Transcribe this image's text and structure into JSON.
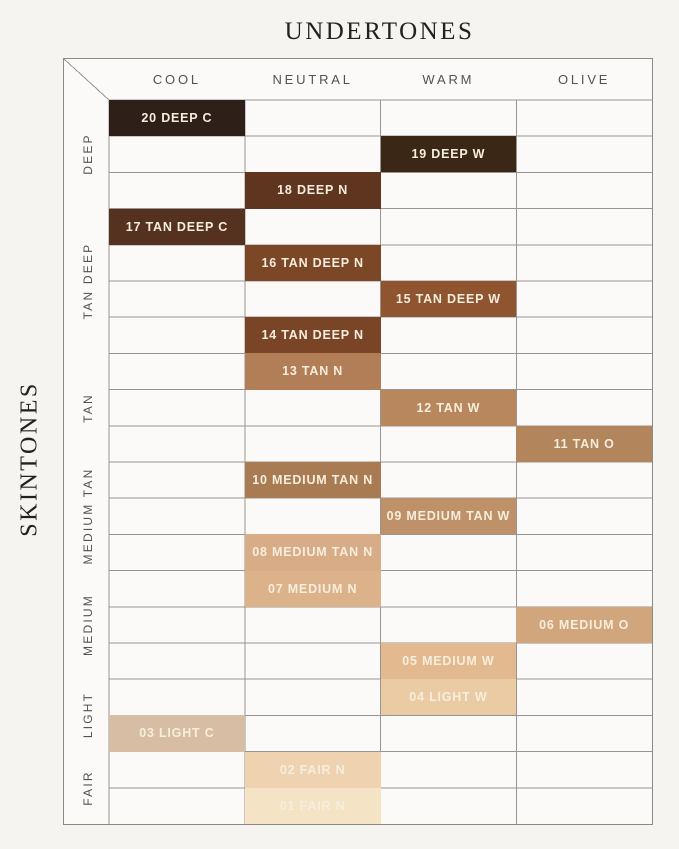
{
  "title": "UNDERTONES",
  "side_title": "SKINTONES",
  "columns": [
    {
      "key": "cool",
      "label": "COOL"
    },
    {
      "key": "neutral",
      "label": "NEUTRAL"
    },
    {
      "key": "warm",
      "label": "WARM"
    },
    {
      "key": "olive",
      "label": "OLIVE"
    }
  ],
  "row_groups": [
    {
      "label": "DEEP",
      "rows": 3
    },
    {
      "label": "TAN DEEP",
      "rows": 4
    },
    {
      "label": "TAN",
      "rows": 3
    },
    {
      "label": "MEDIUM TAN",
      "rows": 3
    },
    {
      "label": "MEDIUM",
      "rows": 3
    },
    {
      "label": "LIGHT",
      "rows": 2
    },
    {
      "label": "FAIR",
      "rows": 2
    }
  ],
  "chart_data": {
    "type": "heatmap",
    "title": "UNDERTONES",
    "ylabel": "SKINTONES",
    "xlabel_categories": [
      "COOL",
      "NEUTRAL",
      "WARM",
      "OLIVE"
    ],
    "ylabel_categories": [
      "DEEP",
      "TAN DEEP",
      "TAN",
      "MEDIUM TAN",
      "MEDIUM",
      "LIGHT",
      "FAIR"
    ],
    "grid": true,
    "cells": [
      {
        "row": 1,
        "column": "COOL",
        "group": "DEEP",
        "shade": "20 DEEP C",
        "color": "#2f1f19"
      },
      {
        "row": 2,
        "column": "WARM",
        "group": "DEEP",
        "shade": "19 DEEP W",
        "color": "#3b2716"
      },
      {
        "row": 3,
        "column": "NEUTRAL",
        "group": "DEEP",
        "shade": "18 DEEP N",
        "color": "#5f3520"
      },
      {
        "row": 4,
        "column": "COOL",
        "group": "TAN DEEP",
        "shade": "17 TAN DEEP C",
        "color": "#553220"
      },
      {
        "row": 5,
        "column": "NEUTRAL",
        "group": "TAN DEEP",
        "shade": "16 TAN DEEP N",
        "color": "#7c4727"
      },
      {
        "row": 6,
        "column": "WARM",
        "group": "TAN DEEP",
        "shade": "15 TAN DEEP W",
        "color": "#8e5530"
      },
      {
        "row": 7,
        "column": "NEUTRAL",
        "group": "TAN DEEP",
        "shade": "14 TAN DEEP N",
        "color": "#7a4527"
      },
      {
        "row": 8,
        "column": "NEUTRAL",
        "group": "TAN",
        "shade": "13 TAN N",
        "color": "#b27e58"
      },
      {
        "row": 9,
        "column": "WARM",
        "group": "TAN",
        "shade": "12 TAN W",
        "color": "#b8875d"
      },
      {
        "row": 10,
        "column": "OLIVE",
        "group": "TAN",
        "shade": "11 TAN O",
        "color": "#b2855c"
      },
      {
        "row": 11,
        "column": "NEUTRAL",
        "group": "MEDIUM TAN",
        "shade": "10 MEDIUM TAN N",
        "color": "#a87b52"
      },
      {
        "row": 12,
        "column": "WARM",
        "group": "MEDIUM TAN",
        "shade": "09 MEDIUM TAN W",
        "color": "#bf9168"
      },
      {
        "row": 13,
        "column": "NEUTRAL",
        "group": "MEDIUM TAN",
        "shade": "08 MEDIUM TAN N",
        "color": "#d7ac86"
      },
      {
        "row": 14,
        "column": "NEUTRAL",
        "group": "MEDIUM",
        "shade": "07 MEDIUM N",
        "color": "#dcb28b"
      },
      {
        "row": 15,
        "column": "OLIVE",
        "group": "MEDIUM",
        "shade": "06 MEDIUM O",
        "color": "#d2a67c"
      },
      {
        "row": 16,
        "column": "WARM",
        "group": "MEDIUM",
        "shade": "05 MEDIUM W",
        "color": "#e3b990"
      },
      {
        "row": 17,
        "column": "WARM",
        "group": "LIGHT",
        "shade": "04 LIGHT W",
        "color": "#ebcba4"
      },
      {
        "row": 18,
        "column": "COOL",
        "group": "LIGHT",
        "shade": "03 LIGHT C",
        "color": "#d7bda4"
      },
      {
        "row": 19,
        "column": "NEUTRAL",
        "group": "FAIR",
        "shade": "02 FAIR N",
        "color": "#efd3b1"
      },
      {
        "row": 20,
        "column": "NEUTRAL",
        "group": "FAIR",
        "shade": "01 FAIR N",
        "color": "#f5e3c6"
      }
    ]
  }
}
